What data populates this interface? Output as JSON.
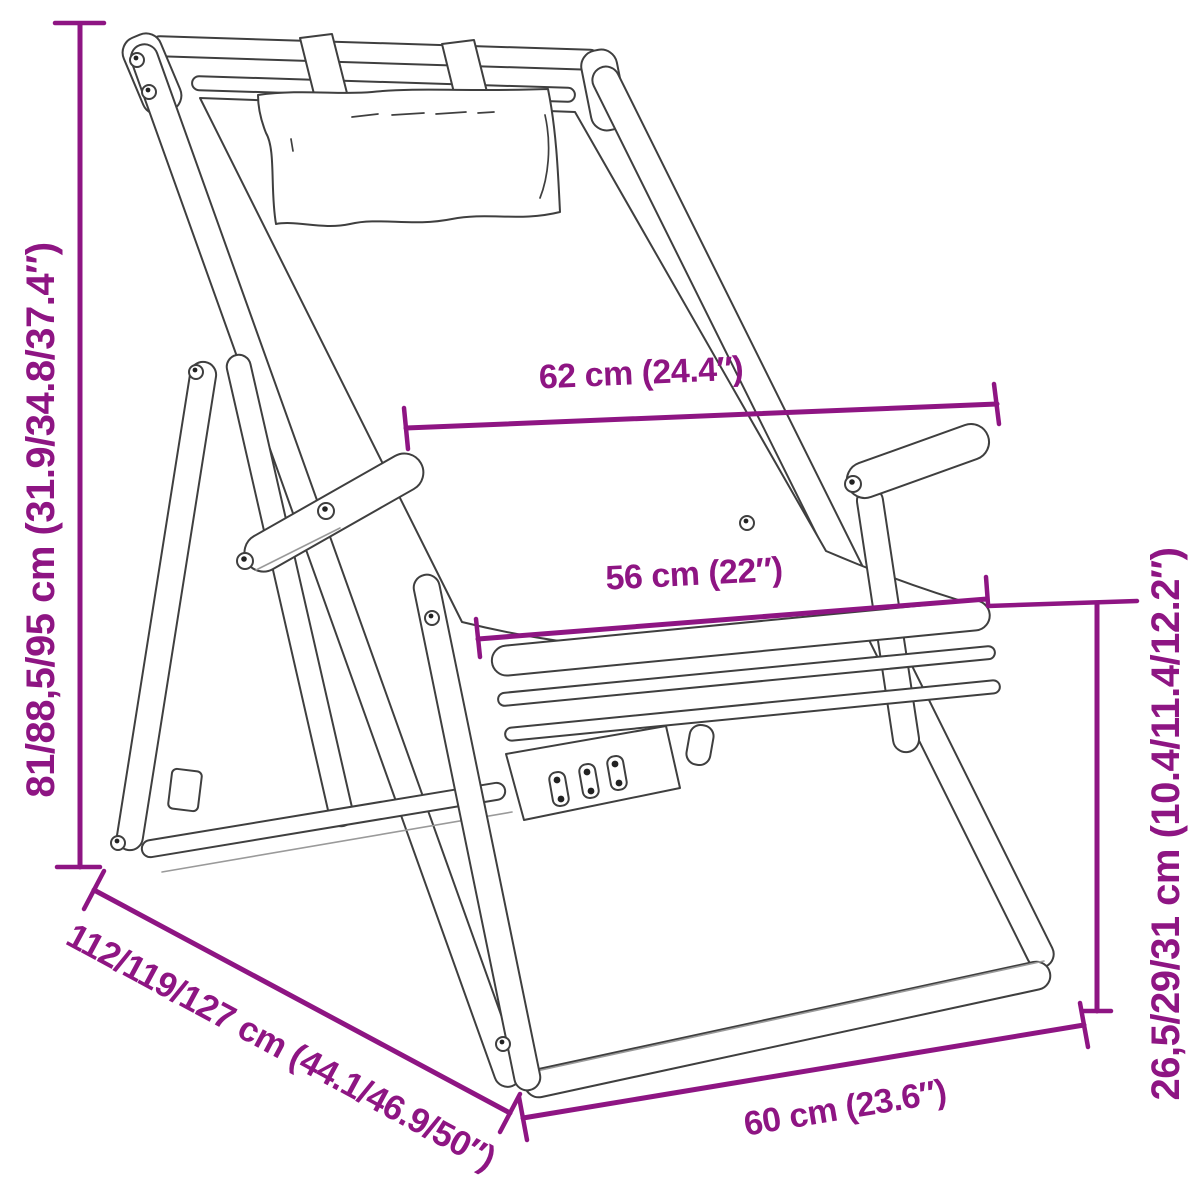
{
  "diagram": {
    "subject": "folding deckchair with headrest pillow - dimension sketch",
    "accent_color": "#8E1583",
    "sketch_line_color": "#3f3f3f",
    "dimensions": [
      {
        "id": "height",
        "label": "81/88,5/95 cm (31.9/34.8/37.4″)",
        "placement": "left-vertical"
      },
      {
        "id": "back_width",
        "label": "62 cm (24.4″)",
        "placement": "upper-middle"
      },
      {
        "id": "seat_width",
        "label": "56 cm (22″)",
        "placement": "middle"
      },
      {
        "id": "depth",
        "label": "112/119/127 cm (44.1/46.9/50″)",
        "placement": "bottom-left-diagonal"
      },
      {
        "id": "front_width",
        "label": "60 cm (23.6″)",
        "placement": "bottom"
      },
      {
        "id": "seat_height",
        "label": "26,5/29/31 cm (10.4/11.4/12.2″)",
        "placement": "right-vertical"
      }
    ]
  }
}
